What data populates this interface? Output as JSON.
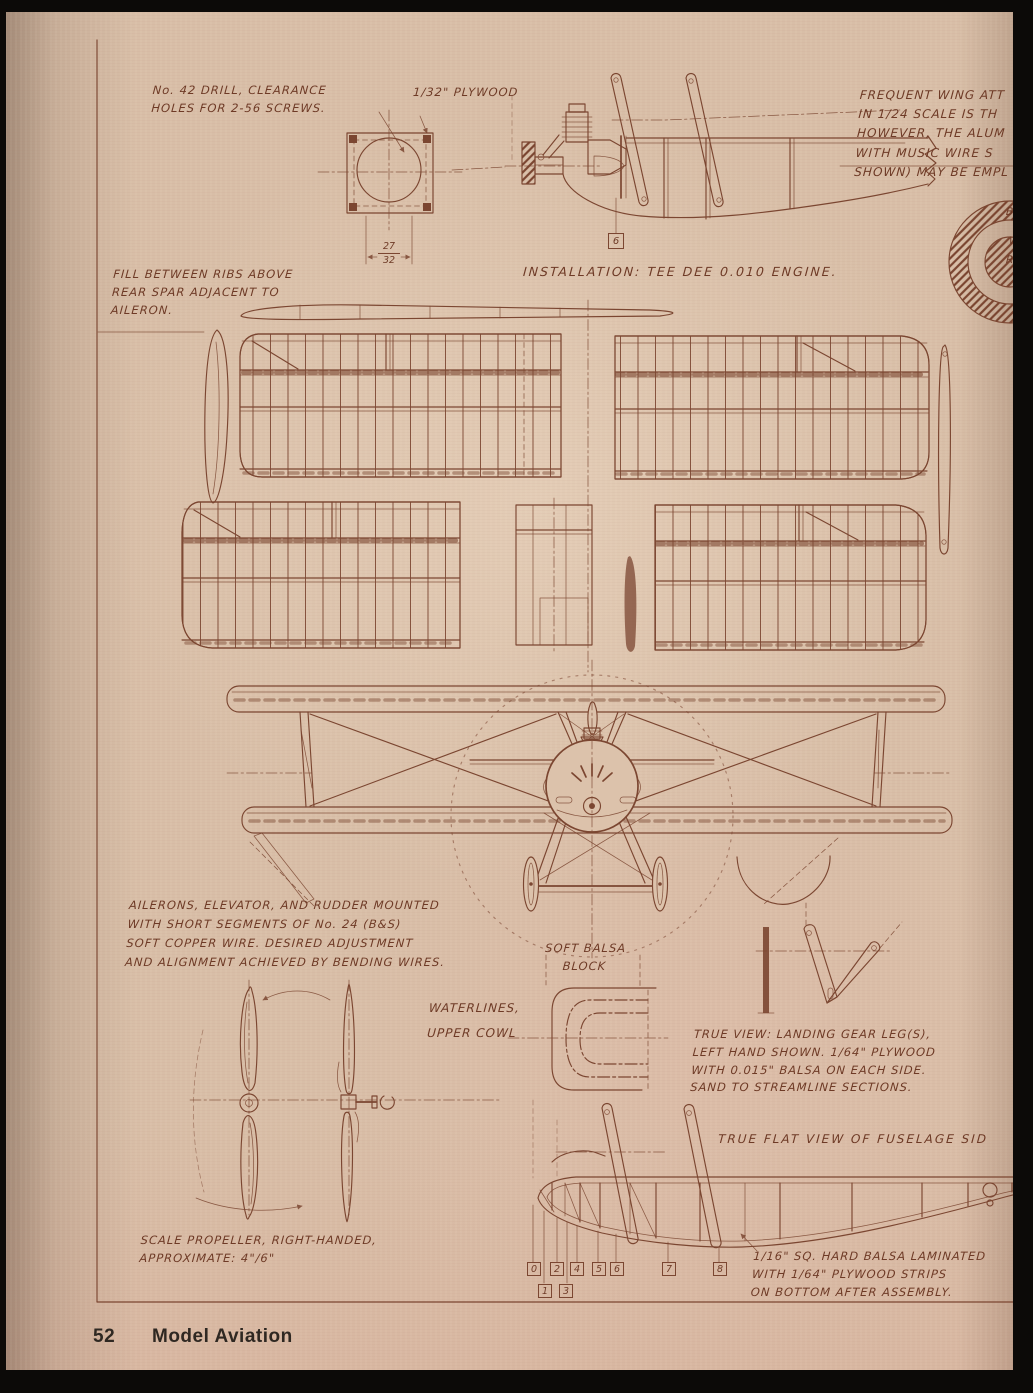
{
  "colors": {
    "paper": "#d8bea7",
    "ink": "#7b4631",
    "hand_text": "#6e3a26",
    "footer_text": "#2f2822",
    "scan_edge": "#0c0a08"
  },
  "footer": {
    "page_number": "52",
    "magazine_title": "Model Aviation"
  },
  "annotations": {
    "drill_note": "No. 42 DRILL, CLEARANCE\nHOLES FOR 2-56 SCREWS.",
    "plywood_note": "1/32\" PLYWOOD",
    "wing_attach_note": "FREQUENT WING ATT\nIN 1/24 SCALE IS TH\nHOWEVER, THE ALUM\nWITH MUSIC WIRE S\nSHOWN) MAY BE EMPL",
    "installation_caption": "INSTALLATION: TEE DEE 0.010 ENGINE.",
    "fill_note": "FILL BETWEEN RIBS ABOVE\nREAR SPAR ADJACENT TO\nAILERON.",
    "aileron_note": "AILERONS, ELEVATOR, AND RUDDER MOUNTED\nWITH SHORT SEGMENTS OF No. 24 (B&S)\nSOFT COPPER WIRE. DESIRED ADJUSTMENT\nAND ALIGNMENT ACHIEVED BY BENDING WIRES.",
    "soft_balsa_label": "SOFT BALSA\nBLOCK",
    "waterlines_label": "WATERLINES,\nUPPER COWL",
    "landing_gear_note": "TRUE VIEW: LANDING GEAR LEG(S),\nLEFT HAND SHOWN. 1/64\" PLYWOOD\nWITH 0.015\" BALSA ON EACH SIDE.\nSAND TO STREAMLINE SECTIONS.",
    "fuselage_caption": "TRUE FLAT VIEW OF FUSELAGE SID",
    "propeller_note": "SCALE PROPELLER, RIGHT-HANDED,\nAPPROXIMATE: 4\"/6\"",
    "balsa_laminated_note": "1/16\" SQ. HARD BALSA LAMINATED\nWITH 1/64\" PLYWOOD STRIPS\nON BOTTOM AFTER ASSEMBLY.",
    "roundel_labels": {
      "line1": "BL",
      "line2": "WA",
      "line3": "RE"
    }
  },
  "firewall_dimension": {
    "numerator": "27",
    "denominator": "32"
  },
  "engine_station_label": "6",
  "fuselage_stations": [
    "0",
    "1",
    "2",
    "3",
    "4",
    "5",
    "6",
    "7",
    "8"
  ]
}
